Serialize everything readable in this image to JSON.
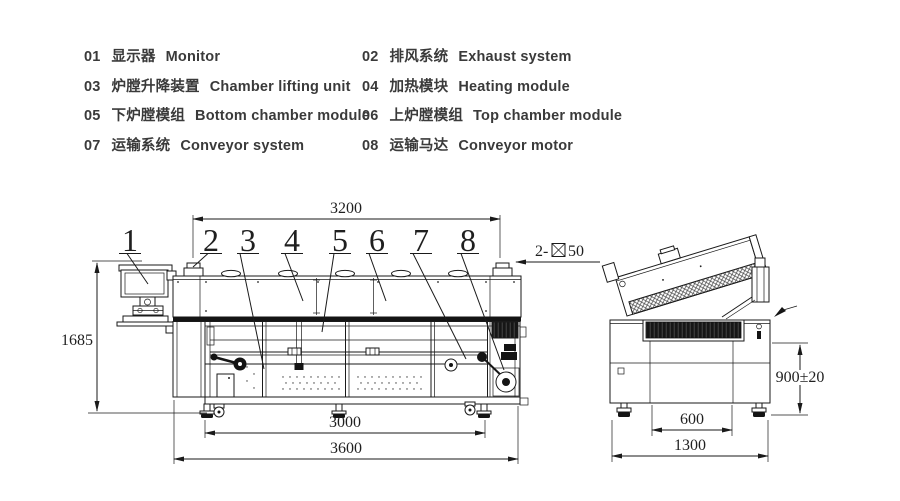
{
  "legend": {
    "items": [
      {
        "num": "01",
        "cn": "显示器",
        "en": "Monitor"
      },
      {
        "num": "02",
        "cn": "排风系统",
        "en": "Exhaust system"
      },
      {
        "num": "03",
        "cn": "炉膛升降装置",
        "en": "Chamber lifting unit"
      },
      {
        "num": "04",
        "cn": "加热模块",
        "en": "Heating module"
      },
      {
        "num": "05",
        "cn": "下炉膛模组",
        "en": "Bottom chamber module"
      },
      {
        "num": "06",
        "cn": "上炉膛模组",
        "en": "Top chamber module"
      },
      {
        "num": "07",
        "cn": "运输系统",
        "en": "Conveyor system"
      },
      {
        "num": "08",
        "cn": "运输马达",
        "en": "Conveyor motor"
      }
    ]
  },
  "front_view": {
    "callouts": [
      "1",
      "2",
      "3",
      "4",
      "5",
      "6",
      "7",
      "8"
    ],
    "dims": {
      "top_width": "3200",
      "height": "1685",
      "feet_span": "3000",
      "overall_length": "3600"
    },
    "annotation": {
      "prefix": "2-",
      "suffix": "50",
      "symbol": "square-with-x-exhaust-port"
    }
  },
  "side_view": {
    "dims": {
      "rail_height": "900±20",
      "inner_width": "600",
      "overall_width": "1300"
    }
  },
  "colors": {
    "line": "#1a1a1a",
    "text": "#3a3a3a",
    "background": "#ffffff"
  }
}
